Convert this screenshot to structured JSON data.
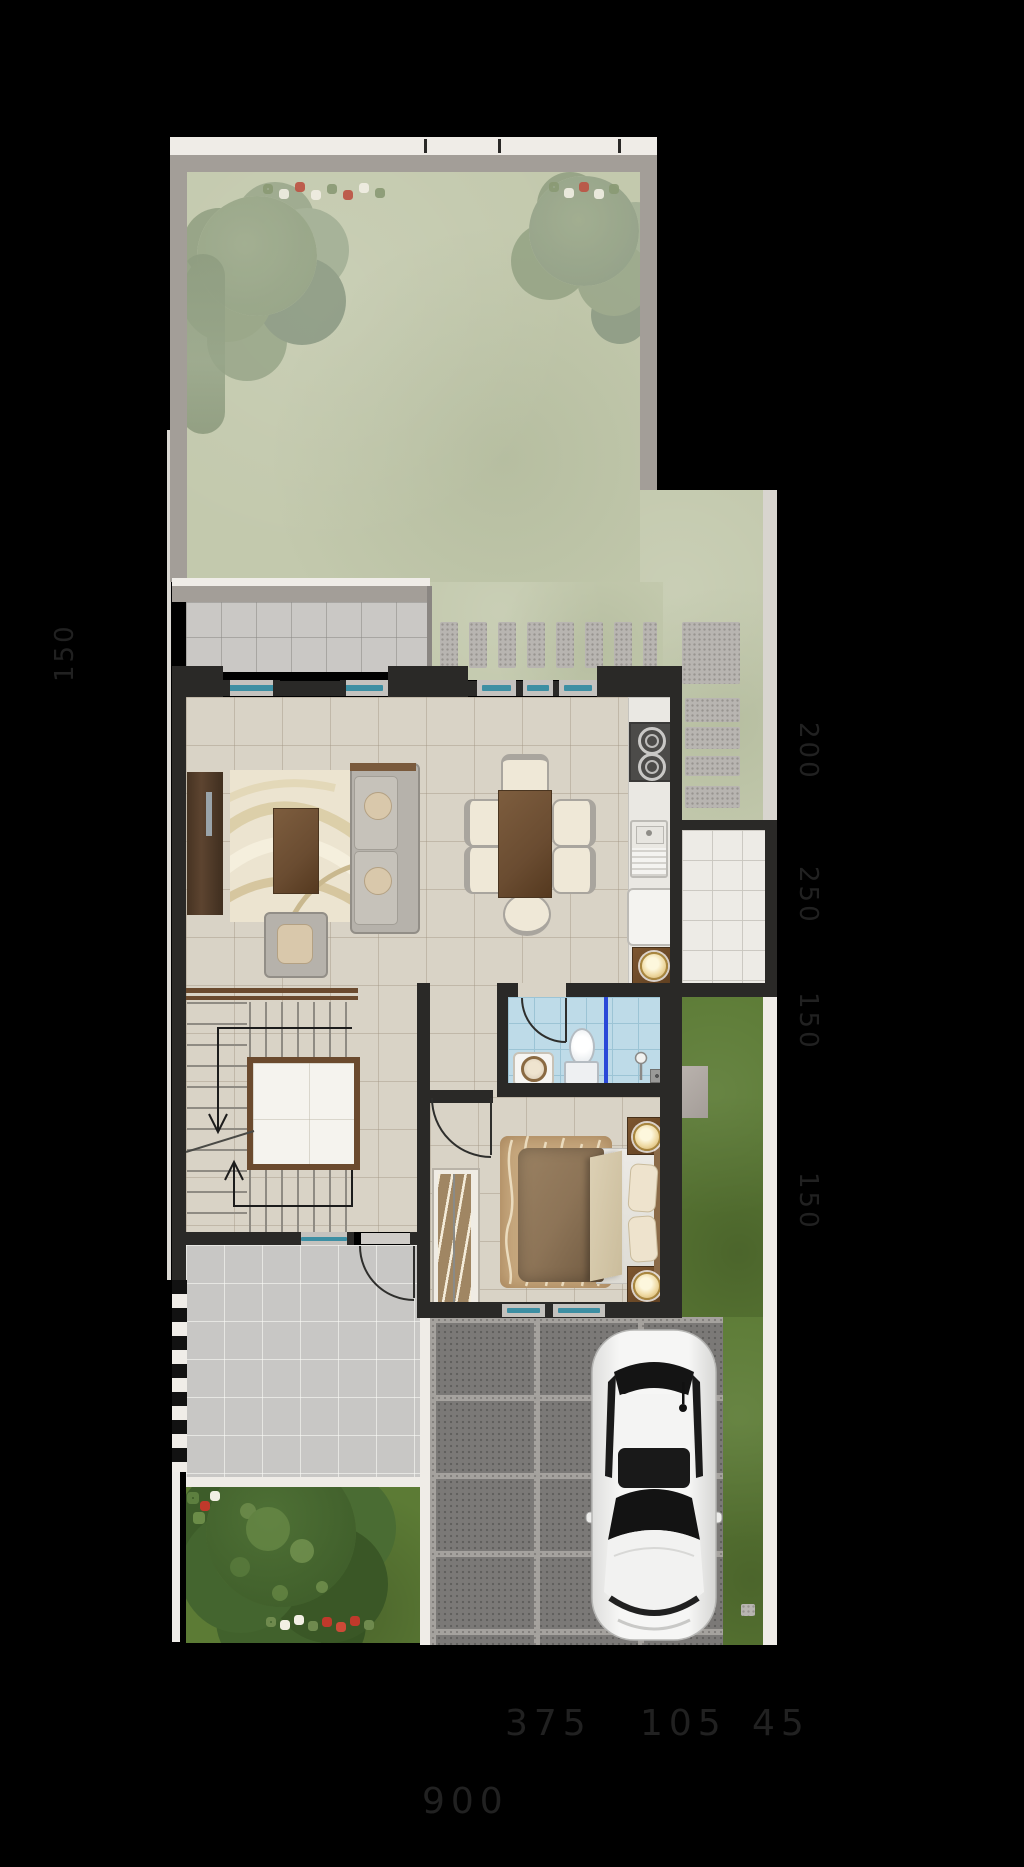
{
  "scene": {
    "type": "residential ground-floor plan, top-down render",
    "background": "#000000"
  },
  "dims": {
    "left": [
      "150"
    ],
    "right": [
      "200",
      "250",
      "150",
      "150"
    ],
    "bottom": [
      "375",
      "105",
      "45",
      "900"
    ]
  },
  "colors": {
    "bg": "#000000",
    "wallDark": "#2a2927",
    "boundaryGray": "#a39e98",
    "whiteStrip": "#efece7",
    "grassFaded": "#c3c9ad",
    "grassVivid": "#5c7b35",
    "floorBeige": "#d9d3c6",
    "terraceGray": "#cac8c5",
    "porchGray": "#c8c7c5",
    "stone": "#b8b5b1",
    "glassTeal": "#3d8fa3",
    "sillGray": "#c4c2be",
    "bathBlue": "#bedbe8",
    "bathLine": "#9cc4d5",
    "partitionBlue": "#2a49d8",
    "sofaGray": "#b6b2ab",
    "cushionTan": "#d9c8ab",
    "bedrugTan": "#c7a87e",
    "pillowCream": "#eee3cd",
    "counterWhite": "#eae8e3",
    "pavers": "#7b7977",
    "paverJoint": "#a5a29e",
    "utilityTile": "#edebe6",
    "carWhite": "#f3f3f2",
    "carGlass": "#161616",
    "ghost": "#212121"
  }
}
